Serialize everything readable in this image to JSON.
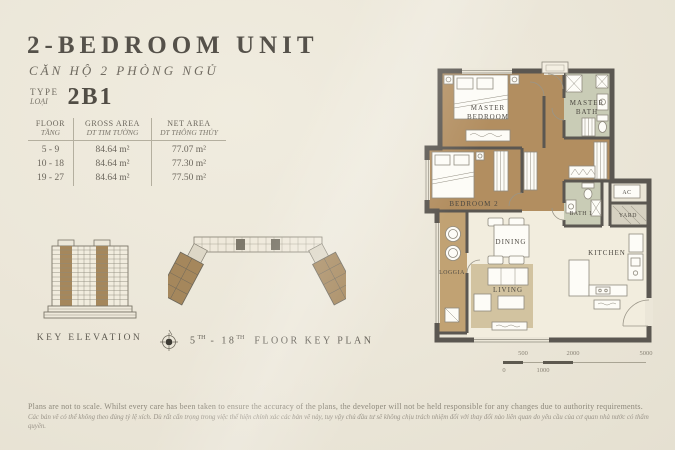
{
  "header": {
    "title": "2-BEDROOM UNIT",
    "subtitle": "CĂN HỘ 2 PHÒNG NGỦ",
    "type_label_en": "TYPE",
    "type_label_vi": "LOẠI",
    "type_value": "2B1"
  },
  "area_table": {
    "columns": {
      "floor_en": "FLOOR",
      "floor_vi": "TẦNG",
      "gross_en": "GROSS AREA",
      "gross_vi": "DT TIM TƯỜNG",
      "net_en": "NET AREA",
      "net_vi": "DT THÔNG THỦY"
    },
    "rows": [
      {
        "floor": "5 - 9",
        "gross": "84.64 m²",
        "net": "77.07 m²"
      },
      {
        "floor": "10 - 18",
        "gross": "84.64 m²",
        "net": "77.30 m²"
      },
      {
        "floor": "19 - 27",
        "gross": "84.64 m²",
        "net": "77.50 m²"
      }
    ]
  },
  "key_elevation": {
    "label": "KEY ELEVATION"
  },
  "key_plan": {
    "floor_from": "5",
    "floor_from_sup": "TH",
    "separator": " - ",
    "floor_to": "18",
    "floor_to_sup": "TH",
    "label": "FLOOR KEY PLAN"
  },
  "floor_plan": {
    "rooms": {
      "master_bedroom_l1": "MASTER",
      "master_bedroom_l2": "BEDROOM",
      "master_bath_l1": "MASTER",
      "master_bath_l2": "BATH",
      "bedroom2": "BEDROOM 2",
      "dining": "DINING",
      "living": "LIVING",
      "loggia": "LOGGIA",
      "bath1": "BATH 1",
      "ac": "AC",
      "yard": "YARD",
      "kitchen": "KITCHEN"
    }
  },
  "scale_bar": {
    "labels_top": [
      "500",
      "2000",
      "5000"
    ],
    "labels_bottom": [
      "0",
      "1000"
    ]
  },
  "footer": {
    "line_en": "Plans are not to scale. Whilst every care has been taken to ensure the accuracy of the plans, the developer will not be held responsible for any changes due to authority requirements.",
    "line_vi": "Các bản vẽ có thể không theo đúng tỷ lệ xích. Dù rất cẩn trọng trong việc thể hiện chính xác các bản vẽ này, tuy vậy chủ đầu tư sẽ không chịu trách nhiệm đối với thay đổi nào liên quan do yêu cầu của cơ quan nhà nước có thẩm quyền."
  },
  "colors": {
    "background": "#ebe6d8",
    "accent_brown": "#a5875c",
    "wood_floor": "#b28e60",
    "wall": "#5b5751",
    "bath_floor": "#c9ccb6",
    "text_dark": "#55514a",
    "text_footer": "#8d887b"
  }
}
